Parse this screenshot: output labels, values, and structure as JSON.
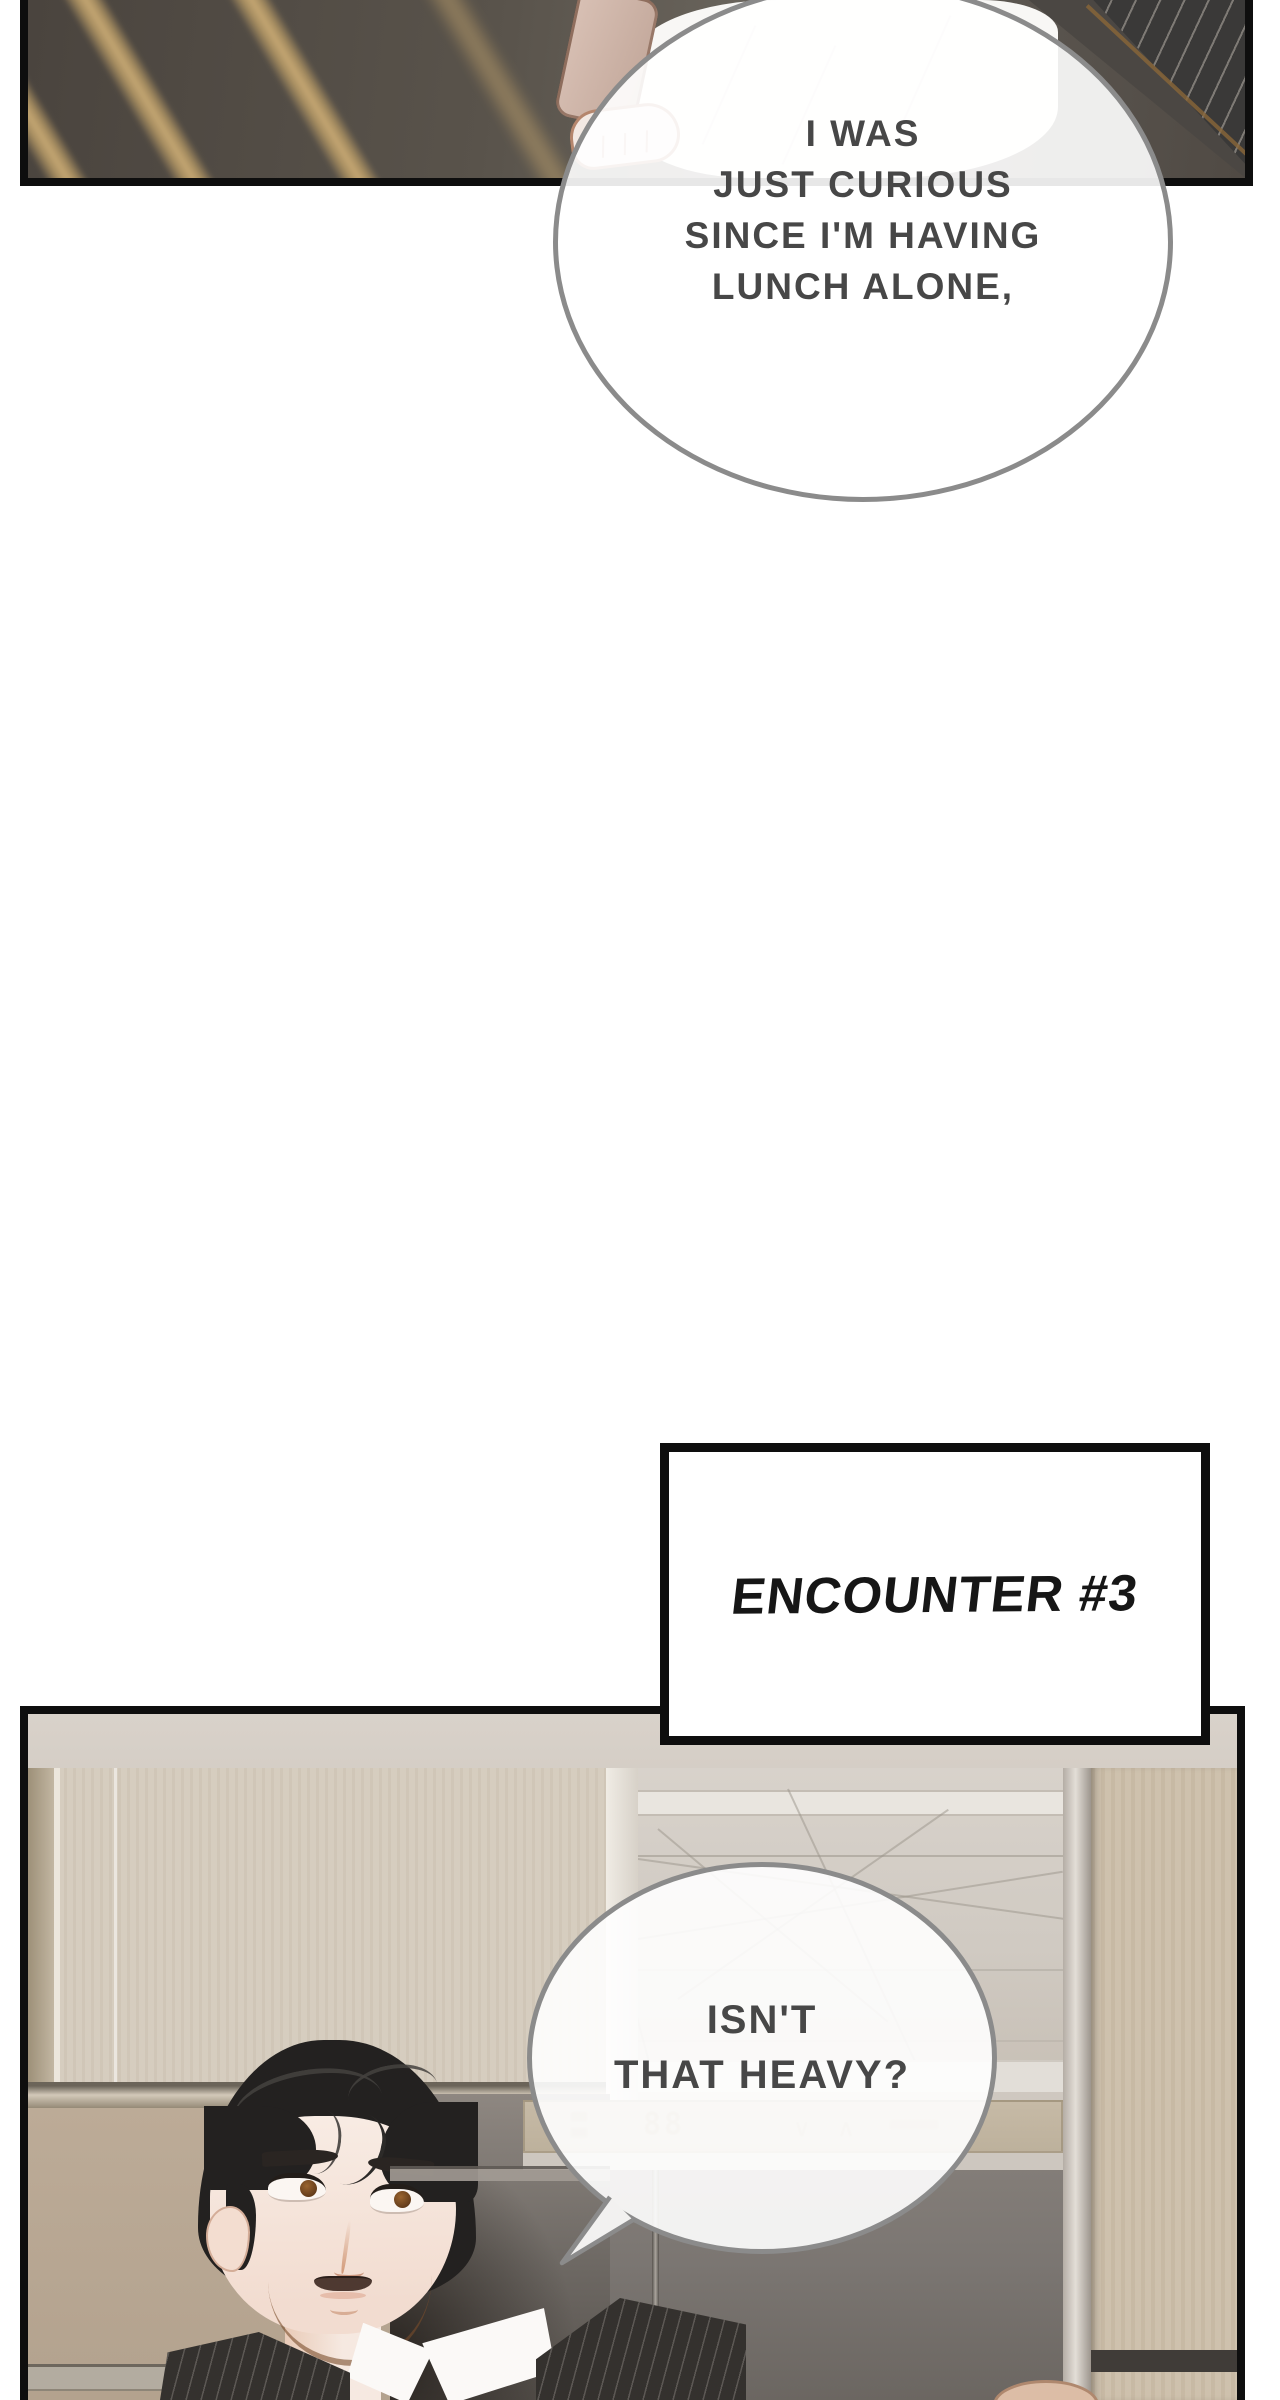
{
  "meta": {
    "kind": "webtoon comic page"
  },
  "bubbles": {
    "b1": {
      "lines": [
        "I WAS",
        "JUST CURIOUS",
        "SINCE I'M HAVING",
        "LUNCH ALONE,"
      ]
    },
    "b2": {
      "lines": [
        "ISN'T",
        "THAT HEAVY?"
      ]
    }
  },
  "caption": {
    "label": "ENCOUNTER #3"
  },
  "elevator_display": {
    "digits": "88",
    "arrows": "∨ ∧"
  },
  "colors": {
    "panel_border": "#0e0e0e",
    "bubble_border": "#8b8b8b",
    "bubble_fill": "rgba(255,255,255,0.9)",
    "bubble_text": "#474747",
    "caption_text": "#161616",
    "beam_gold": "#c4a672",
    "blazer_white": "#f8f7f5",
    "sleeve_rose": "#c2a79a",
    "skin_light": "#f3e9e3",
    "suit_dark": "#3a3938",
    "ceiling_beige": "#d5cec6",
    "wood_wall": "#d6cdbf",
    "wood_wall_lower": "#b3a28e",
    "wood_pillar": "#cec1ad",
    "glass_gray": "#d0cac2",
    "elevator_door": "#7b7672",
    "indicator_band": "#bdb19c",
    "indicator_glyph": "#9c8a68",
    "hair_black": "#232120",
    "face_skin": "#f6e9e1"
  }
}
